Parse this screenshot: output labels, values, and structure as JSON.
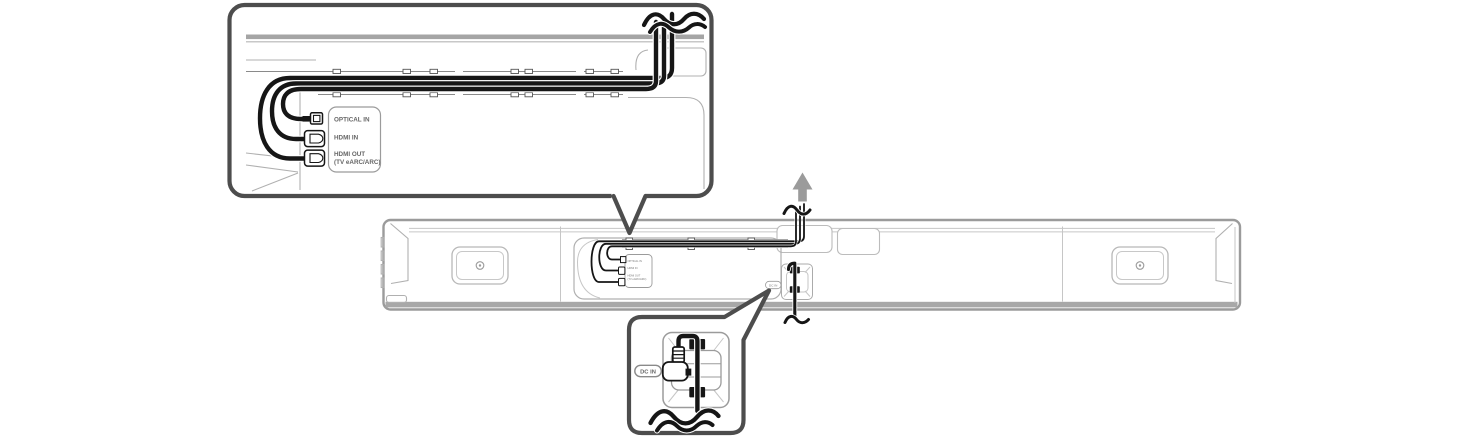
{
  "diagram_title": "Soundbar rear cable routing illustration",
  "colors": {
    "cable": "#161616",
    "callout_border": "#4d4d4d",
    "outline": "#b0b0b0",
    "band": "#a5a5a5",
    "arrow": "#9b9b9b",
    "label_text": "#666666"
  },
  "callout_top": {
    "ports": [
      {
        "label": "OPTICAL IN"
      },
      {
        "label": "HDMI IN"
      },
      {
        "label": "HDMI OUT",
        "sublabel": "(TV eARC/ARC)"
      }
    ]
  },
  "soundbar": {
    "mini_panel": {
      "optical": "OPTICAL IN",
      "hdmi_in": "HDMI IN",
      "hdmi_out": "HDMI OUT",
      "hdmi_out_sub": "(TV eARC/ARC)"
    },
    "dc_port_label": "DC IN"
  },
  "callout_bottom": {
    "dc_port_label": "DC IN"
  },
  "icons": {
    "up_arrow": "up-arrow-icon"
  }
}
